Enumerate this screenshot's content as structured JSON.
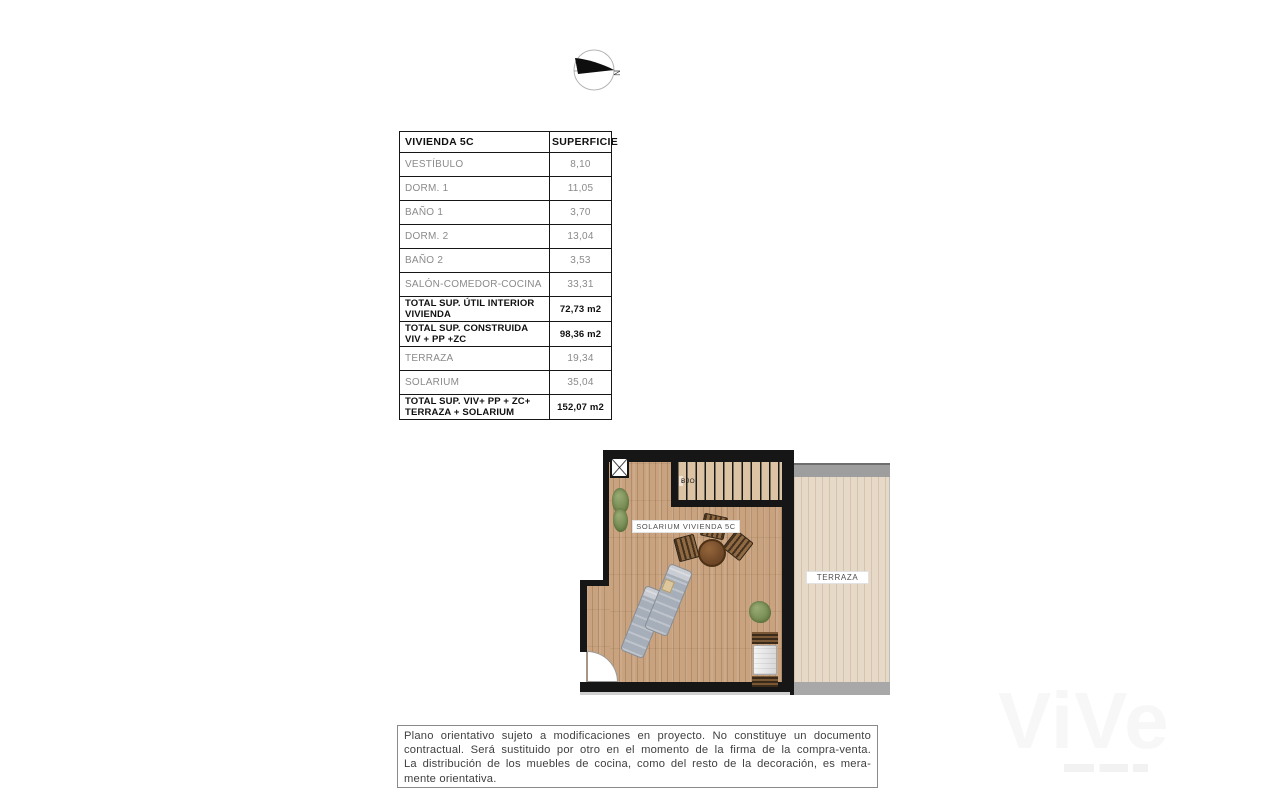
{
  "compass": {
    "north_label": "N"
  },
  "table": {
    "headers": [
      "VIVIENDA 5C",
      "SUPERFICIE"
    ],
    "rows": [
      {
        "label": "VESTÍBULO",
        "value": "8,10",
        "emphasis": false
      },
      {
        "label": "DORM. 1",
        "value": "11,05",
        "emphasis": false
      },
      {
        "label": "BAÑO 1",
        "value": "3,70",
        "emphasis": false
      },
      {
        "label": "DORM. 2",
        "value": "13,04",
        "emphasis": false
      },
      {
        "label": "BAÑO 2",
        "value": "3,53",
        "emphasis": false
      },
      {
        "label": "SALÓN-COMEDOR-COCINA",
        "value": "33,31",
        "emphasis": false
      },
      {
        "label": "TOTAL SUP. ÚTIL INTERIOR VIVIENDA",
        "value": "72,73 m2",
        "emphasis": true
      },
      {
        "label": "TOTAL SUP. CONSTRUIDA VIV + PP +ZC",
        "value": "98,36 m2",
        "emphasis": true
      },
      {
        "label": "TERRAZA",
        "value": "19,34",
        "emphasis": false
      },
      {
        "label": "SOLARIUM",
        "value": "35,04",
        "emphasis": false
      },
      {
        "label": "TOTAL SUP. VIV+ PP + ZC+ TERRAZA + SOLARIUM",
        "value": "152,07 m2",
        "emphasis": true
      }
    ]
  },
  "plan": {
    "solarium_label": "SOLARIUM VIVIENDA 5C",
    "terraza_label": "TERRAZA",
    "stairs_arrow": "‹",
    "stairs_label": "BJO",
    "colors": {
      "wall": "#161616",
      "solarium_floor": "#c9a37f",
      "terraza_floor": "#e7d9c7",
      "stairs_floor": "#dcc3a3",
      "gray_band": "#9e9e9e",
      "plant": "#70864e",
      "table_top": "#6b4526",
      "lounger": "#a6aeb9"
    }
  },
  "disclaimer": {
    "lines": [
      "Plano orientativo sujeto a modificaciones en proyecto. No constituye un documento",
      "contractual. Será sustituido por otro en el momento de la firma de la compra-venta.",
      "La distribución de los muebles de cocina, como del resto de la decoración, es mera-",
      "mente orientativa."
    ]
  },
  "watermark": {
    "text": "ViVe"
  }
}
